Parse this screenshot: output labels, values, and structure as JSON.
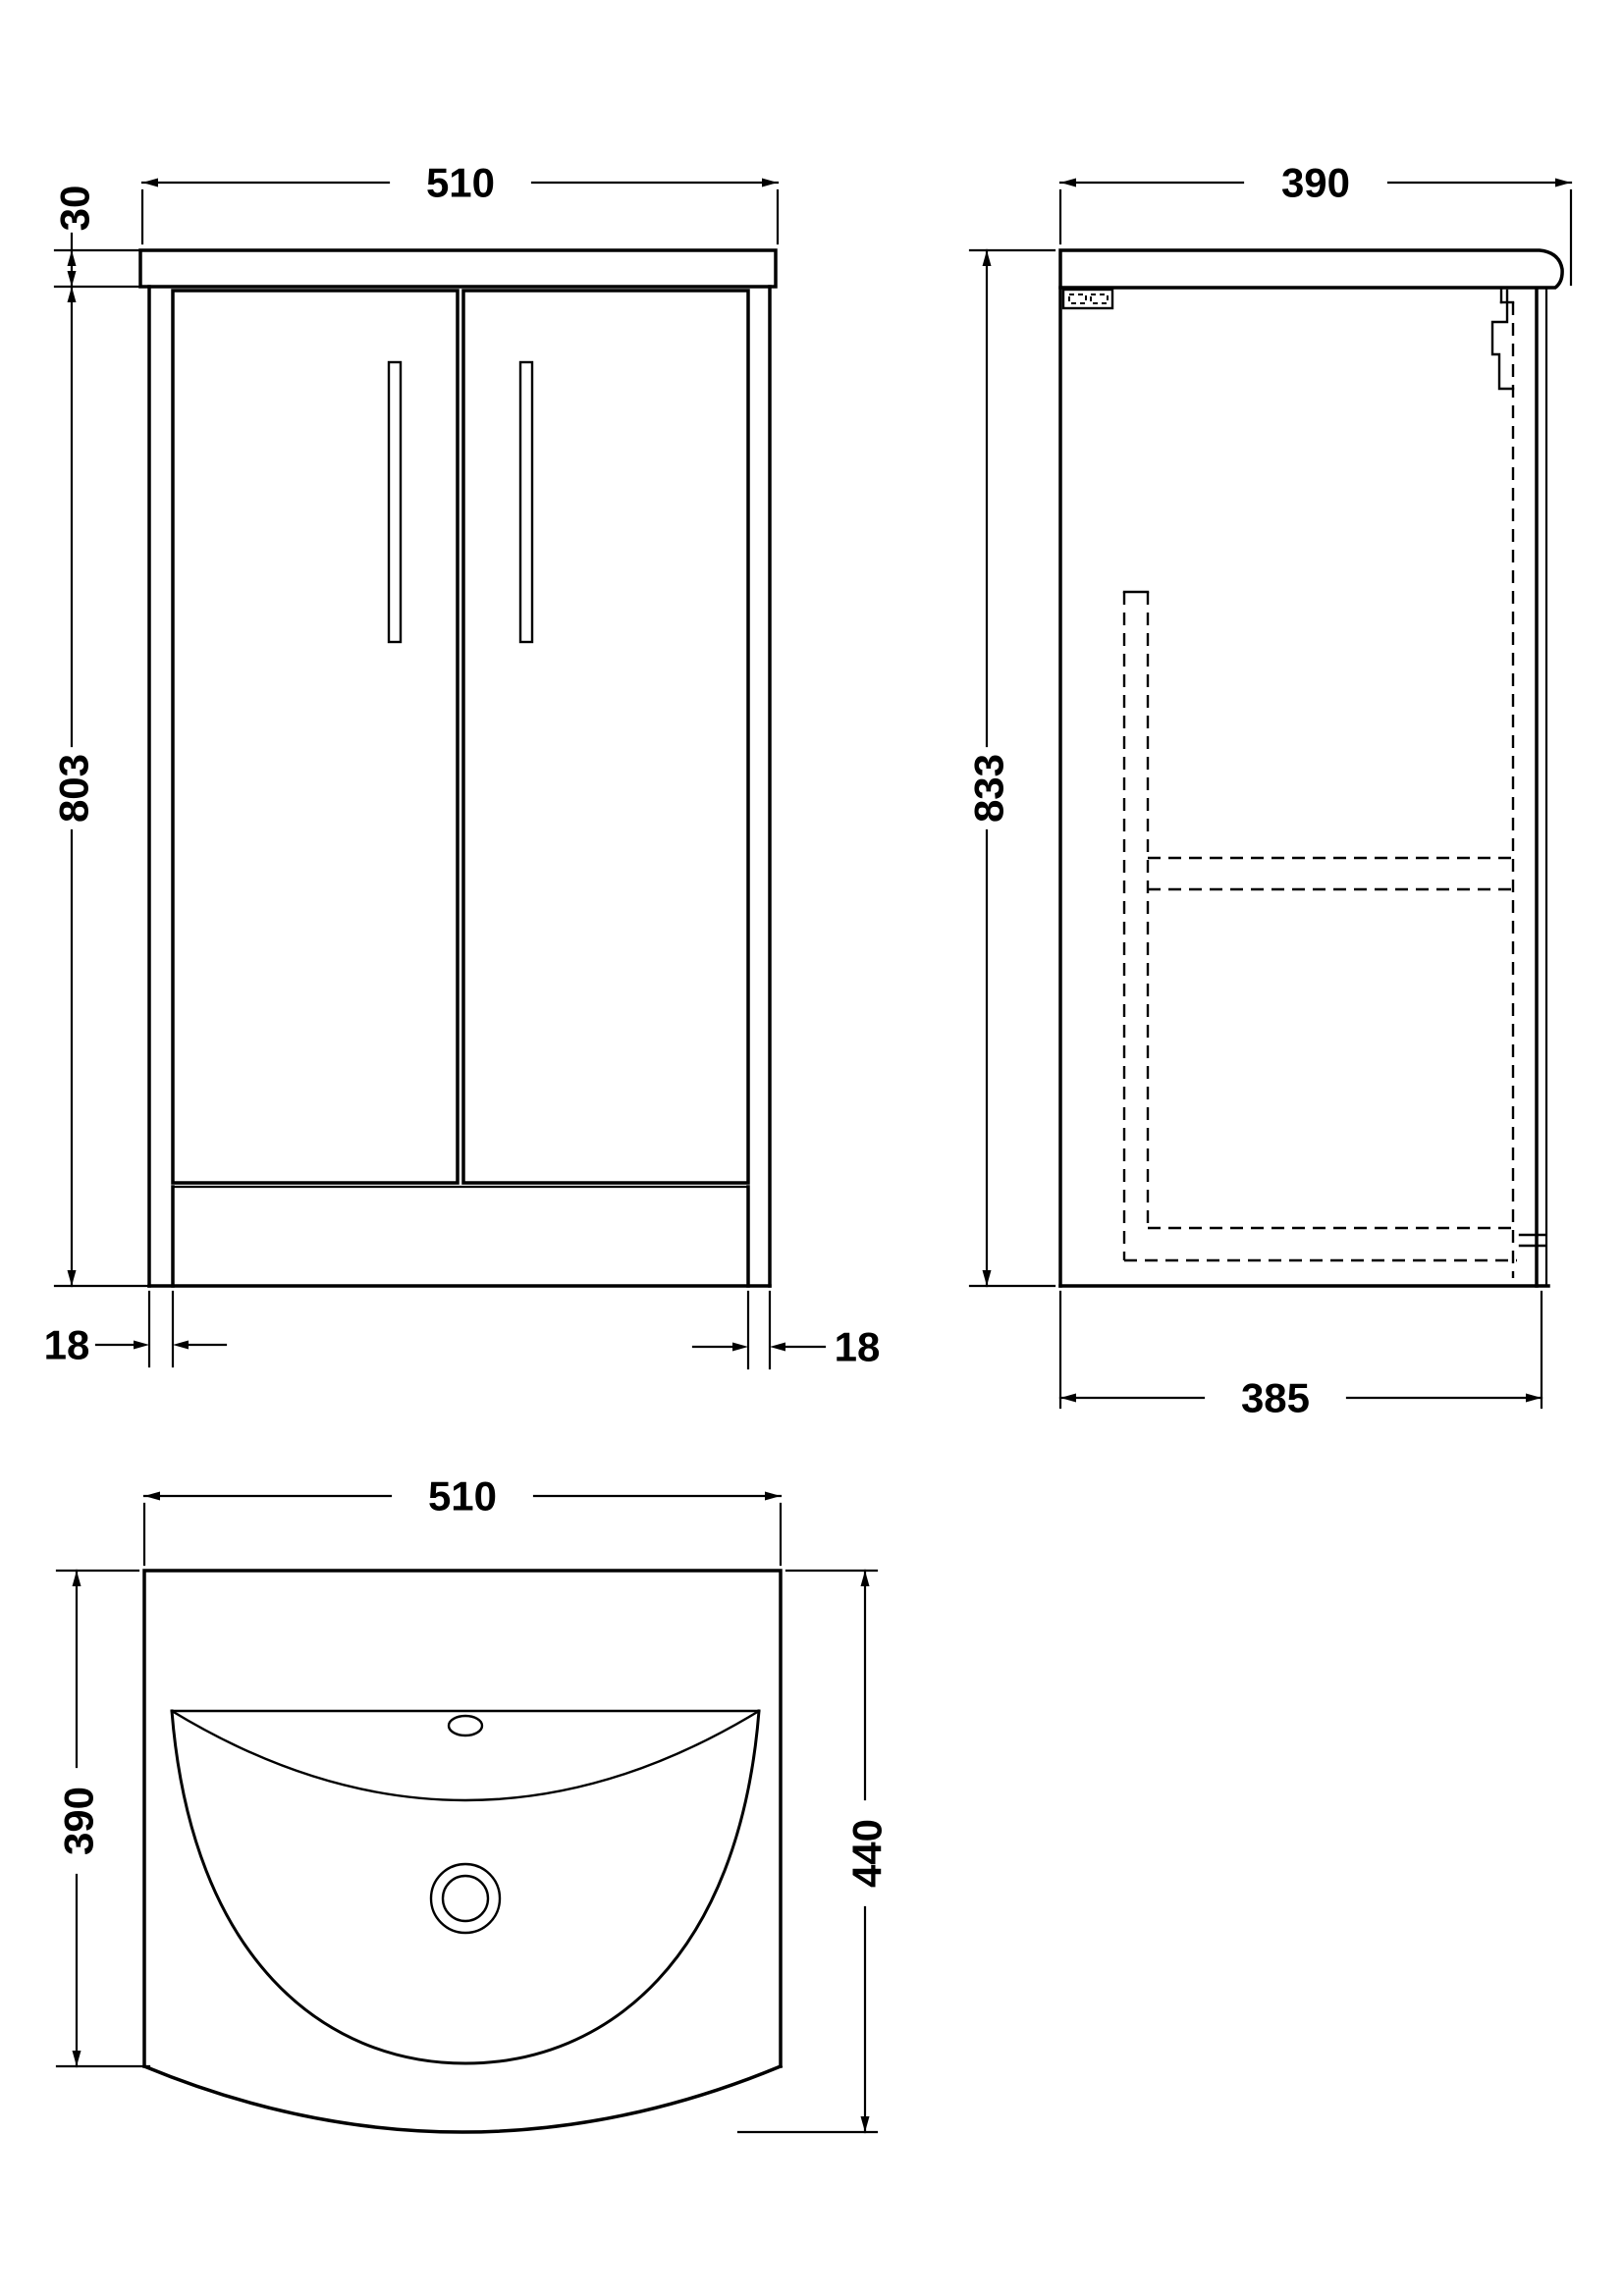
{
  "page": {
    "background": "#ffffff",
    "line_color": "#000000",
    "content": "bathroom vanity unit technical drawing, three orthographic views"
  },
  "views": {
    "front": {
      "label": "front-elevation",
      "dim_width": "510",
      "dim_worktop_thickness": "30",
      "dim_cabinet_height": "803",
      "dim_left_leg_width": "18",
      "dim_right_leg_width": "18"
    },
    "side": {
      "label": "side-elevation",
      "dim_depth": "390",
      "dim_overall_height": "833",
      "dim_cabinet_depth": "385"
    },
    "plan": {
      "label": "plan-view-basin",
      "dim_width": "510",
      "dim_depth_to_front_corner": "390",
      "dim_overall_depth": "440"
    }
  }
}
